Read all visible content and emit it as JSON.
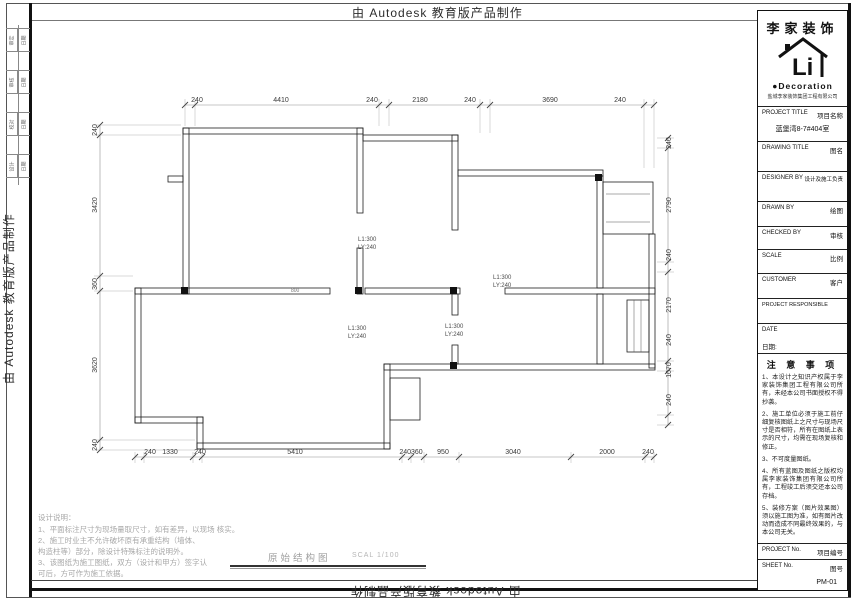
{
  "watermark": "由 Autodesk 教育版产品制作",
  "frame_cells": [
    {
      "a": "审定",
      "b": "日期"
    },
    {
      "a": "审核",
      "b": "日期"
    },
    {
      "a": "校对",
      "b": "日期"
    },
    {
      "a": "设计",
      "b": "日期"
    }
  ],
  "title_block": {
    "brand": "李家装饰",
    "logo_li": "Li",
    "logo_decoration": "●Decoration",
    "company": "盐城李家装饰集团工程有限公司",
    "project_title_en": "PROJECT TITLE",
    "project_title_cn": "项目名称",
    "project_title_value": "蓝堡湾8-7#404室",
    "drawing_title_en": "DRAWING TITLE",
    "drawing_title_cn": "图名",
    "designer_en": "DESIGNER BY",
    "designer_cn": "设计及施工负责",
    "drawn_en": "DRAWN BY",
    "drawn_cn": "绘图",
    "checked_en": "CHECKED BY",
    "checked_cn": "审核",
    "scale_en": "SCALE",
    "scale_cn": "比例",
    "customer_en": "CUSTOMER",
    "customer_cn": "客户",
    "responsible_en": "PROJECT RESPONSIBLE",
    "date_en": "DATE",
    "date_cn": "日期:",
    "notes_title": "注 意 事 项",
    "notes": [
      "1、本设计之知识产权属于李家装饰集团工程有限公司所有，未经本公司书面授权不得抄袭。",
      "2、施工单位必须于施工前仔细复核图纸上之尺寸与现场尺寸是否相符，所有在图纸上表示的尺寸，均需在现场复核和修正。",
      "3、不可度量图纸。",
      "4、所有蓝图及图纸之版权均属李家装饰集团有限公司所有，工程竣工后须交还本公司存档。",
      "5、装修方案（图片效果图）须以施工图为准，如有图片改动而造成不同最终效果的，与本公司无关。"
    ],
    "project_no_en": "PROJECT No.",
    "project_no_cn": "项目编号",
    "sheet_no_en": "SHEET No.",
    "sheet_no_cn": "图号",
    "sheet_no_value": "PM-01"
  },
  "plan": {
    "title": "原始结构图",
    "scale_note": "SCAL 1/100",
    "dims_top": [
      "240",
      "4410",
      "240",
      "2180",
      "240",
      "3690",
      "240"
    ],
    "dims_bottom": [
      "240",
      "1330",
      "240",
      "5410",
      "240360",
      "950",
      "3040",
      "2000",
      "240"
    ],
    "dims_left": [
      "240",
      "3420",
      "360",
      "3620",
      "240"
    ],
    "dims_right": [
      "240",
      "2790",
      "240",
      "2170",
      "240",
      "1070",
      "240"
    ],
    "beam_h": "L1:300",
    "beam_w": "LY:240",
    "wall_tag": "800"
  },
  "design_notes": {
    "title": "设计说明：",
    "lines": [
      "1、平面标注尺寸为现场量取尺寸，如有差异，以现场 核实。",
      "2、施工时业主不允许破坏原有承重结构（墙体、",
      "构造柱等）部分，除设计特殊标注的说明外。",
      "3、该图纸为施工图纸，双方（设计和甲方）签字认",
      "可后，方可作为施工依据。"
    ]
  }
}
